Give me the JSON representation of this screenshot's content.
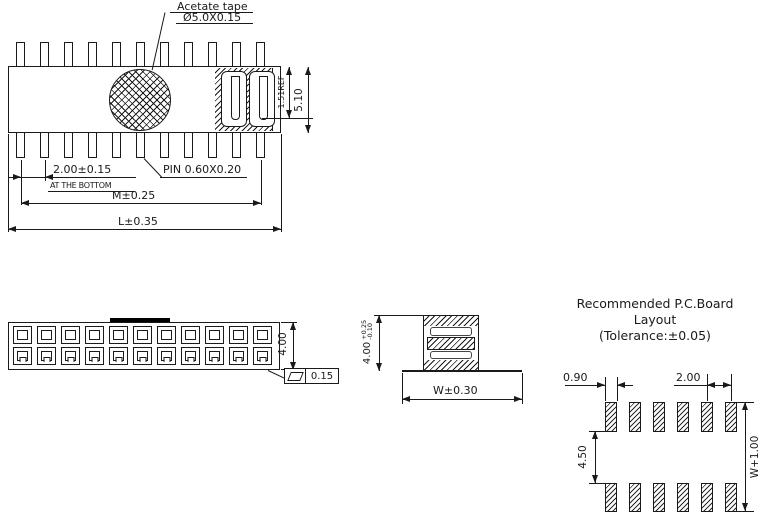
{
  "labels": {
    "acetate_tape": "Acetate tape",
    "tape_size": "Ø5.0X0.15",
    "pin_size": "PIN  0.60X0.20"
  },
  "top_view": {
    "pin_count": 11,
    "dim_pitch": "2.00±0.15",
    "dim_pitch_note": "AT THE BOTTOM",
    "dim_m": "M±0.25",
    "dim_l": "L±0.35",
    "dim_ref_height": "1.51REF",
    "dim_body_height": "5.10"
  },
  "front_view": {
    "hole_columns": 11,
    "hole_rows": 2,
    "dim_height": "4.00",
    "flatness_tolerance": "0.15"
  },
  "side_view": {
    "dim_height": "4.00",
    "dim_height_tol_plus": "+0.25",
    "dim_height_tol_minus": "-0.10",
    "dim_width": "W±0.30"
  },
  "pcb_layout": {
    "title_line1": "Recommended  P.C.Board",
    "title_line2": "Layout",
    "title_line3": "(Tolerance:±0.05)",
    "pad_columns": 6,
    "dim_pad_width": "0.90",
    "dim_pitch": "2.00",
    "dim_row_gap": "4.50",
    "dim_overall": "W+1.00"
  },
  "colors": {
    "line": "#1a1a1a",
    "background": "#ffffff"
  }
}
